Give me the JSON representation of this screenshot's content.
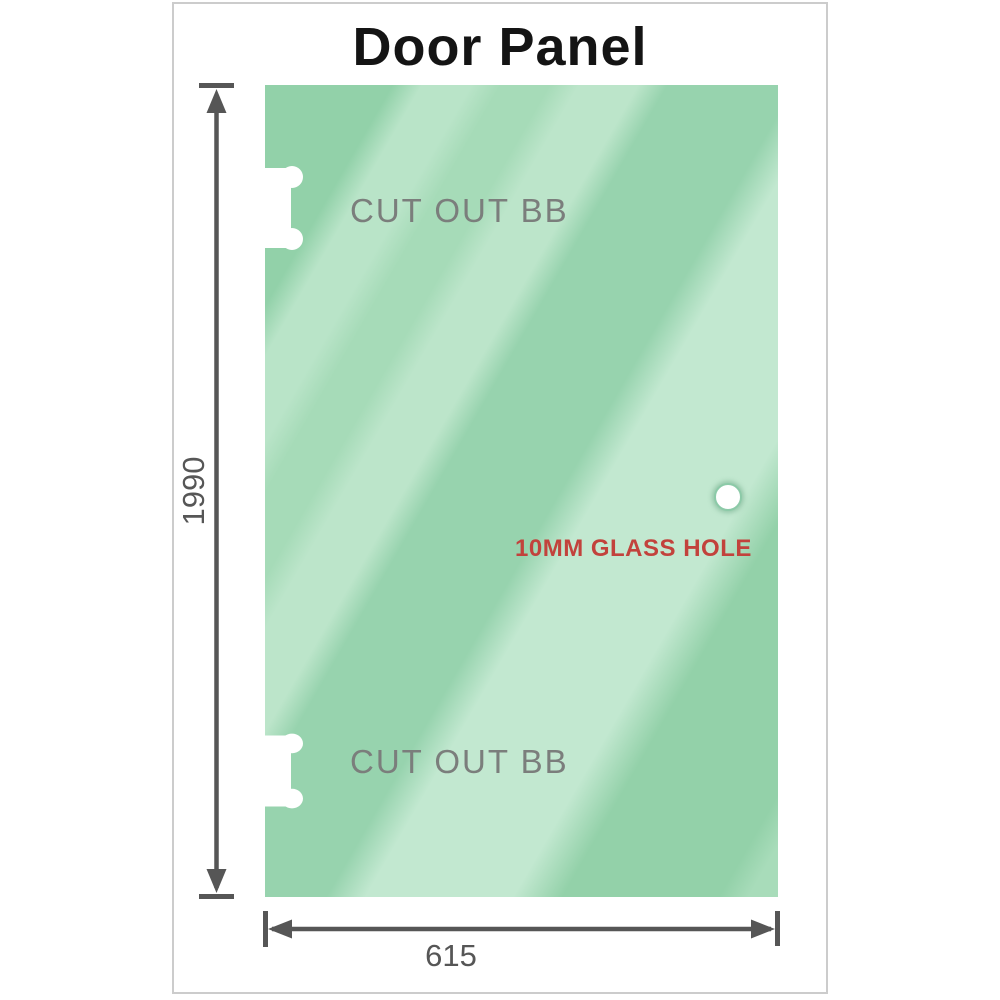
{
  "title": "Door Panel",
  "diagram": {
    "height_dimension": "1990",
    "width_dimension": "615",
    "cutouts": [
      {
        "label": "CUT OUT BB"
      },
      {
        "label": "CUT OUT BB"
      }
    ],
    "glass_hole_label": "10MM GLASS HOLE"
  },
  "colors": {
    "glass_green_base": "#97d3ae",
    "glass_green_light": "#c2e8d0",
    "glass_green_dark": "#92d1a9",
    "dimension_gray": "#565656",
    "cutout_label_gray": "#7b7e7c",
    "hole_label_red": "#c2423c",
    "title_black": "#141414",
    "frame_border_gray": "#cccccc",
    "cutout_white": "#ffffff"
  }
}
